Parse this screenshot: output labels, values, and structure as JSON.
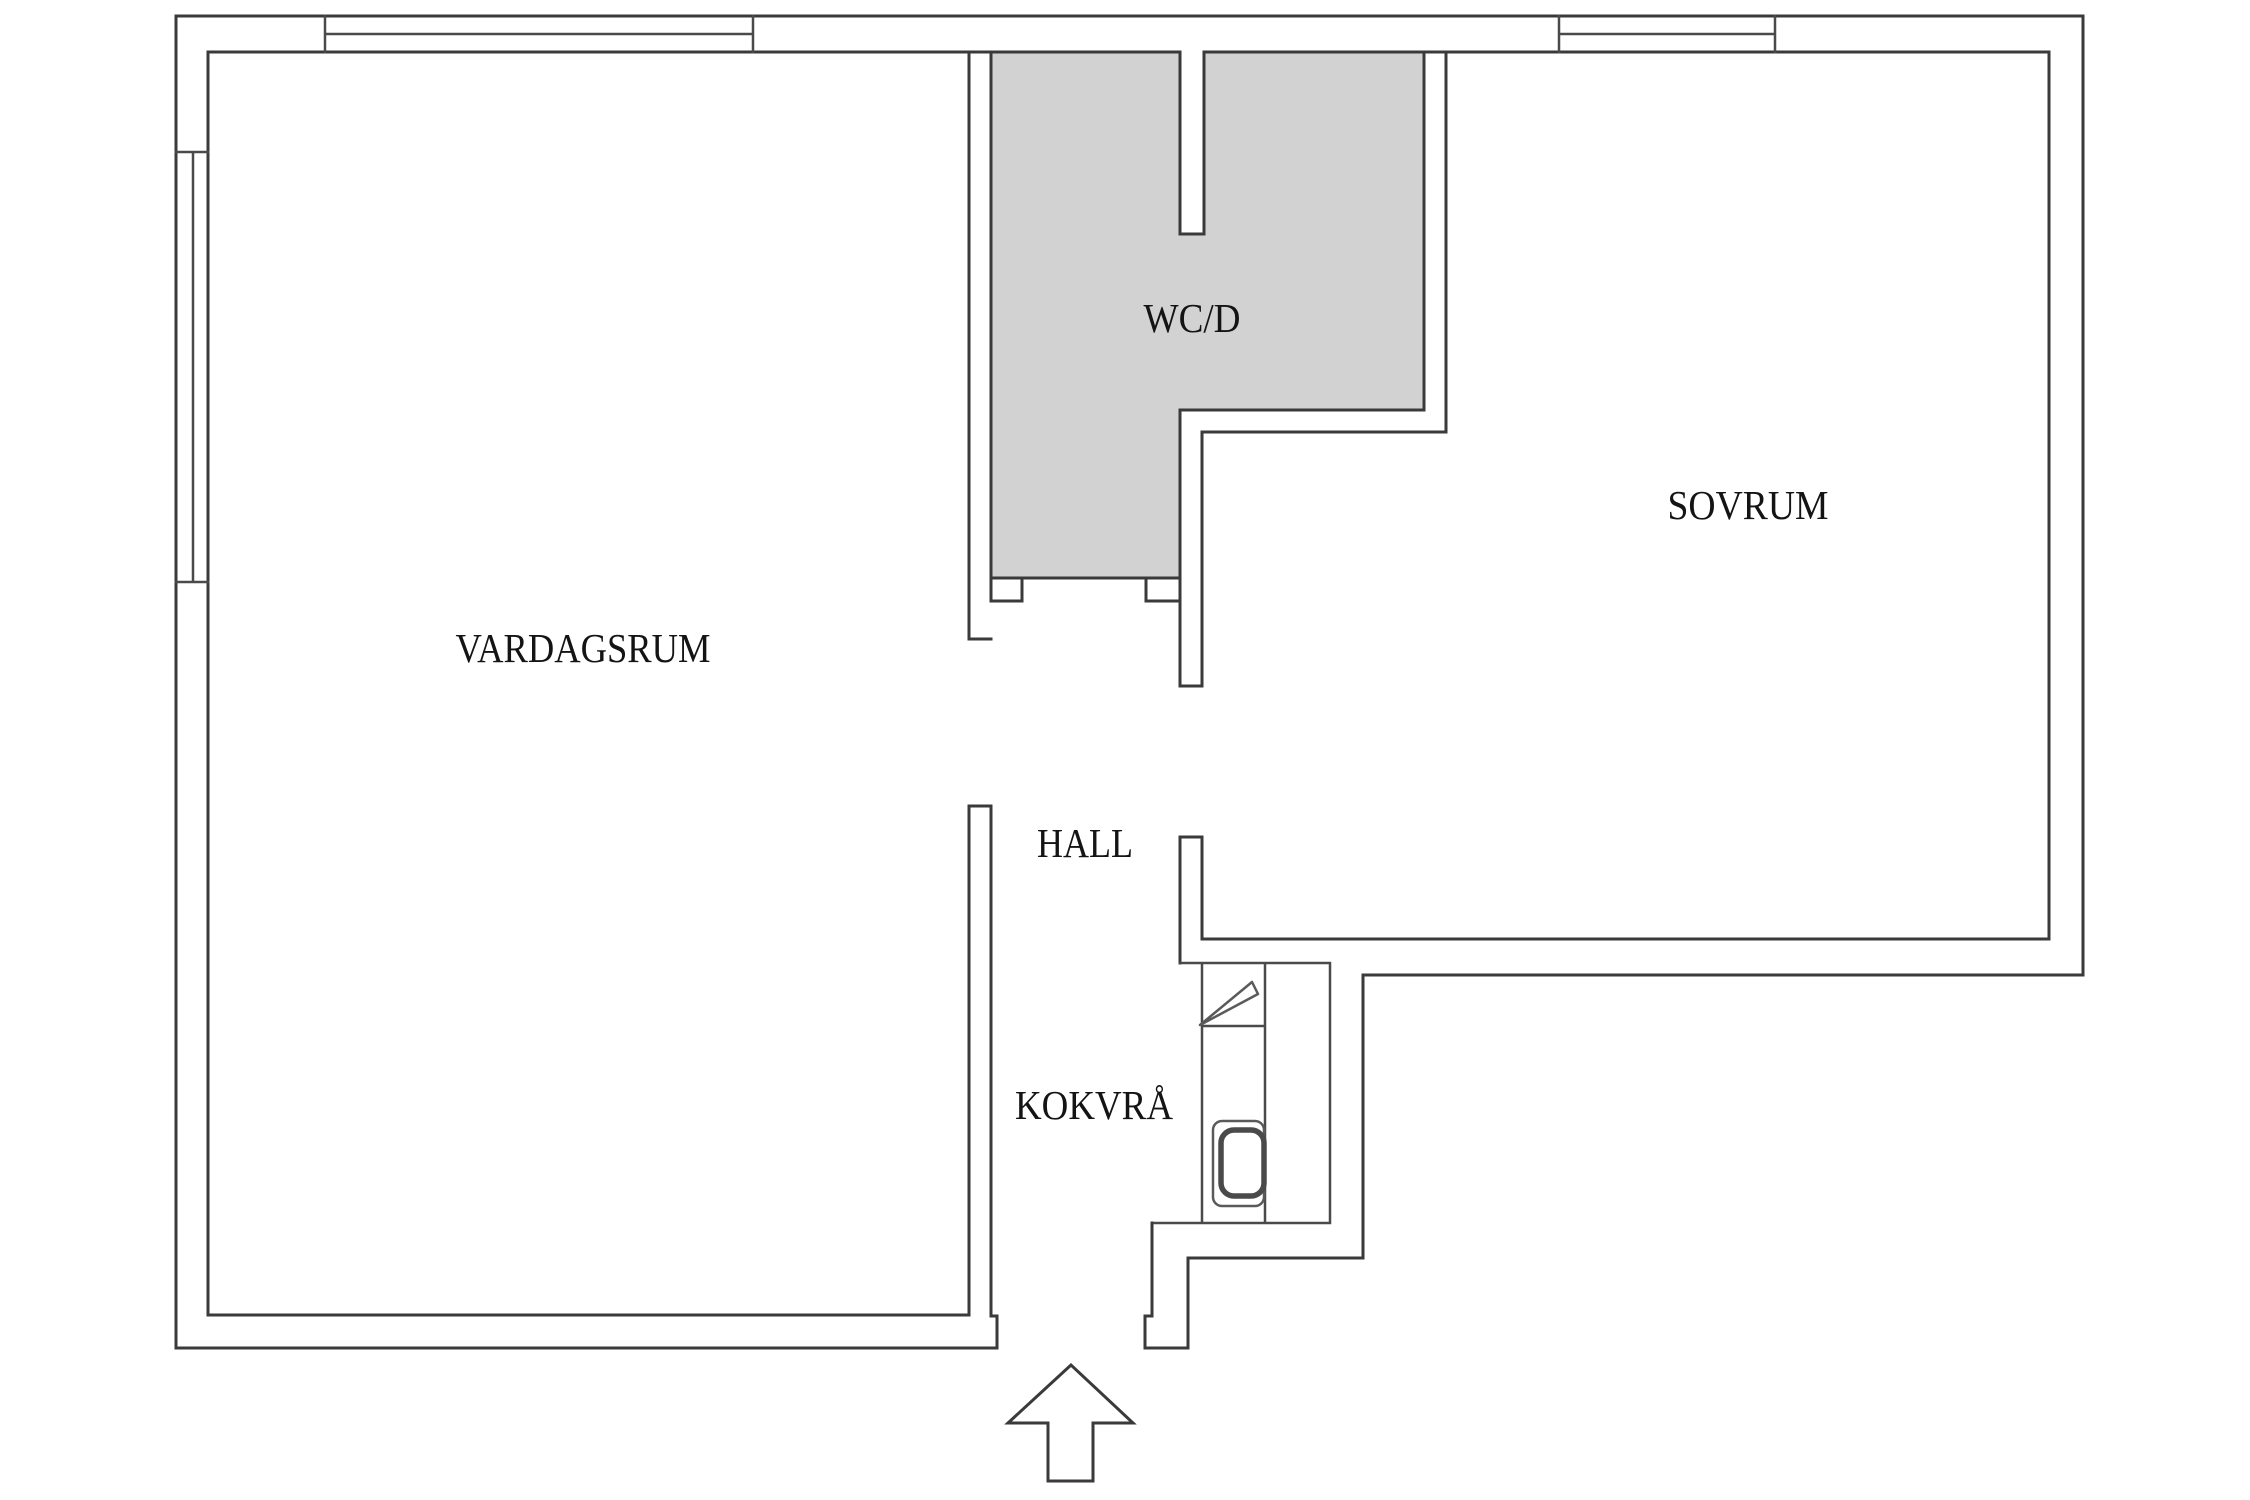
{
  "floor_plan": {
    "rooms": [
      {
        "id": "vardagsrum",
        "label": "VARDAGSRUM"
      },
      {
        "id": "wc-d",
        "label": "WC/D"
      },
      {
        "id": "sovrum",
        "label": "SOVRUM"
      },
      {
        "id": "hall",
        "label": "HALL"
      },
      {
        "id": "kokvra",
        "label": "KOKVRÅ"
      }
    ],
    "fixtures": [
      {
        "id": "kitchen-counter",
        "icon": "counter-icon"
      },
      {
        "id": "kitchen-sink",
        "icon": "sink-icon"
      },
      {
        "id": "stove-marker",
        "icon": "triangle-icon"
      },
      {
        "id": "entrance",
        "icon": "entrance-arrow-icon"
      }
    ],
    "colors": {
      "wall_line": "#3a3a3a",
      "wet_room_fill": "#d2d2d2",
      "label_text": "#141414",
      "background": "#ffffff"
    }
  }
}
